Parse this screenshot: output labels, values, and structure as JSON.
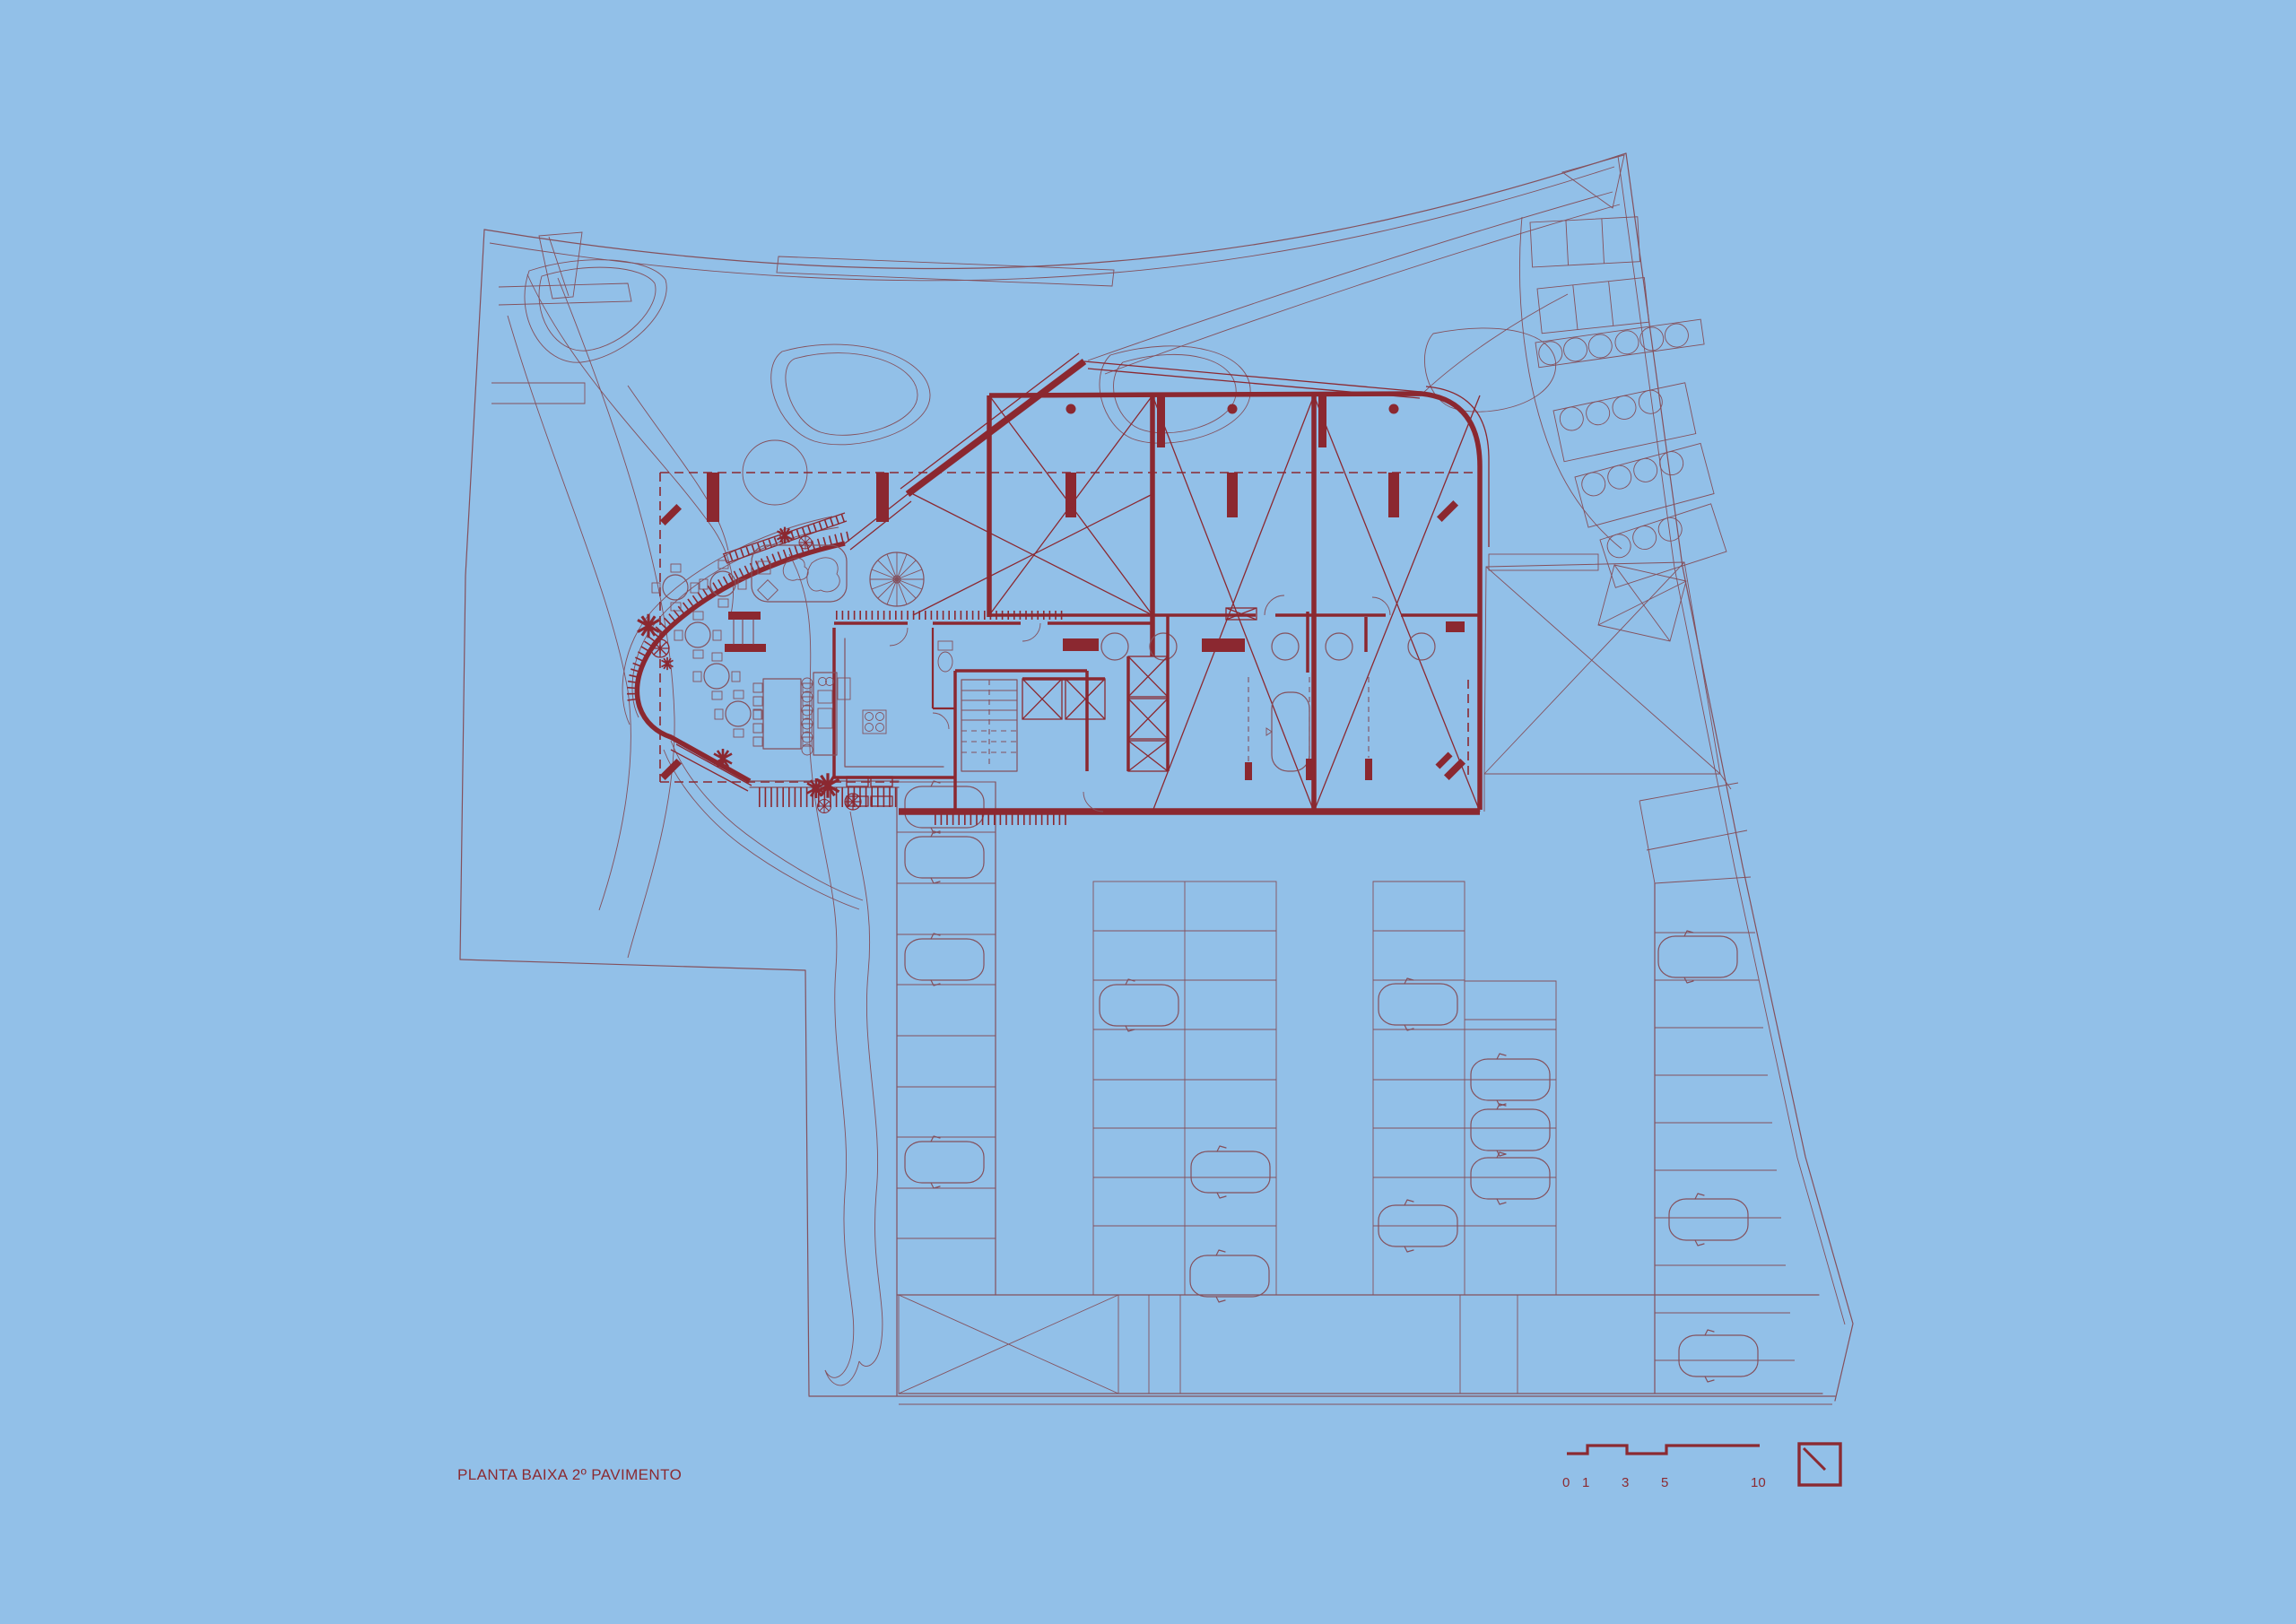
{
  "titleblock": {
    "title": "PLANTA BAIXA 2º PAVIMENTO"
  },
  "scalebar": {
    "labels": [
      "0",
      "1",
      "3",
      "5",
      "10"
    ],
    "unit_note": "graphic scale in meters"
  },
  "symbols": {
    "north_indicator": "north-indicator-icon",
    "spiral_stair": "spiral-stair-icon",
    "plants": "plant-icon",
    "cars": "car-icon"
  },
  "palette": {
    "background": "#92c0e8",
    "site_linework": "#84505c",
    "building_red": "#8b2830",
    "text_red": "#8b2a31"
  },
  "drawing": {
    "type": "architectural floor plan",
    "floor": "2º pavimento (second floor)",
    "features": "site boundary, landscape contours, restaurant terrace with tables, three cross-braced halls, bathrooms, kitchen, spiral stair, elevator core, parking lot with cars, stepped parking rows"
  }
}
